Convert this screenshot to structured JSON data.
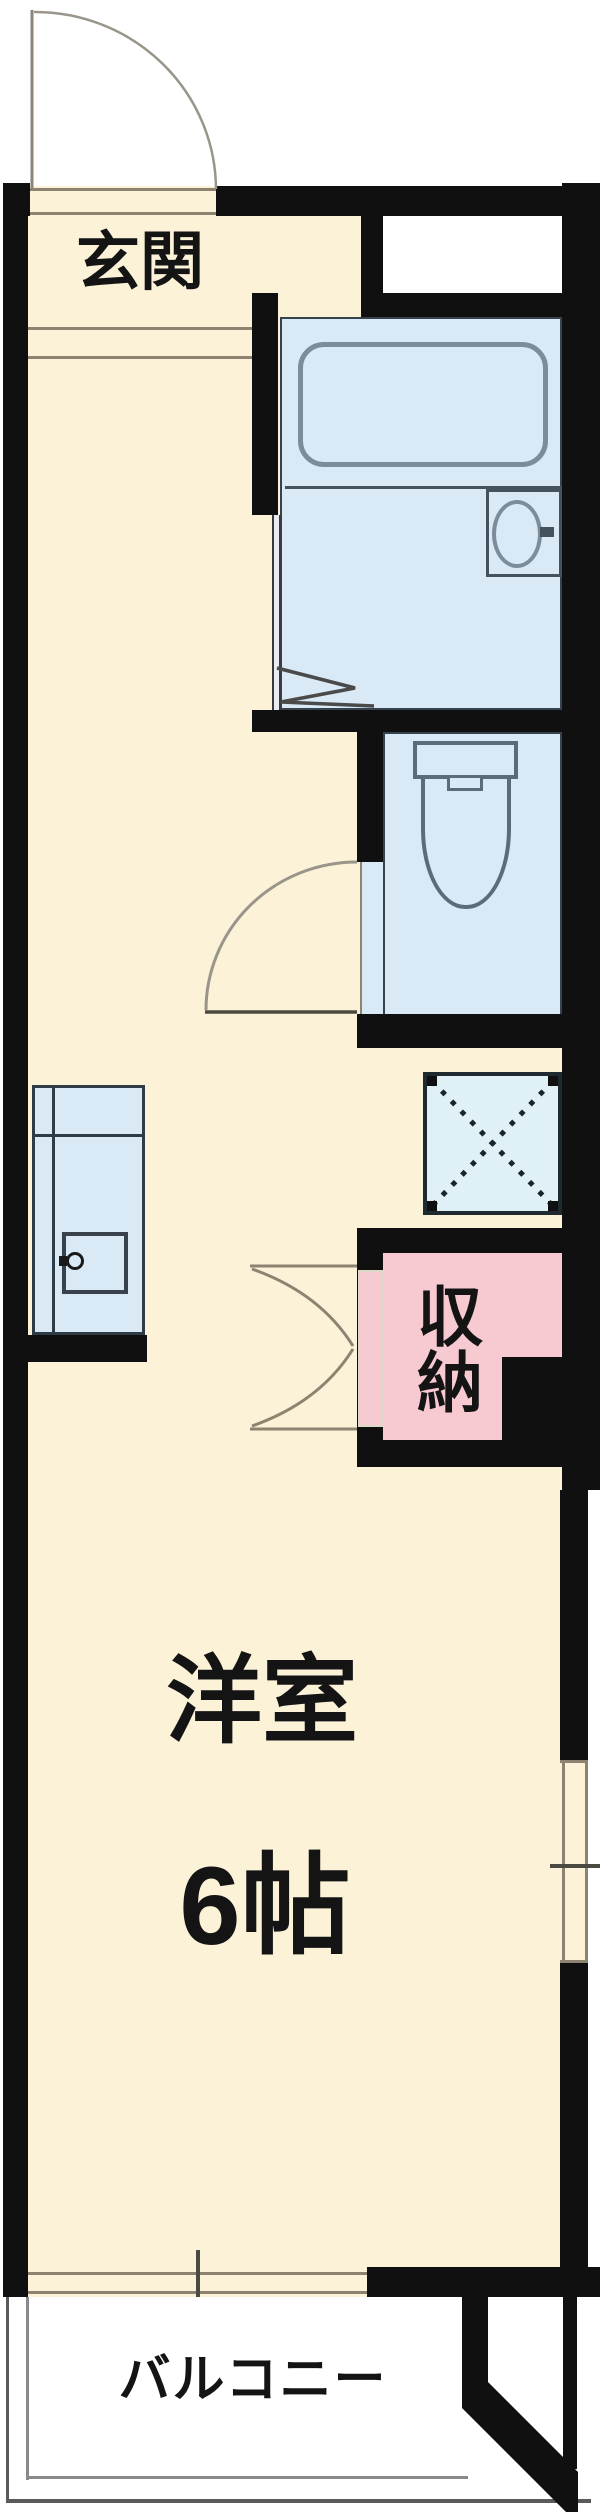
{
  "labels": {
    "entrance": "玄関",
    "storage": "収納",
    "western_room": "洋室",
    "room_size": "6帖",
    "balcony": "バルコニー"
  },
  "rooms": [
    {
      "name": "entrance",
      "label": "玄関"
    },
    {
      "name": "bathroom",
      "label": ""
    },
    {
      "name": "toilet",
      "label": ""
    },
    {
      "name": "kitchen",
      "label": ""
    },
    {
      "name": "washer-pan",
      "label": ""
    },
    {
      "name": "storage",
      "label": "収納"
    },
    {
      "name": "western-room",
      "label": "洋室",
      "size": "6帖"
    },
    {
      "name": "balcony",
      "label": "バルコニー"
    }
  ],
  "colors": {
    "wall": "#101010",
    "floor": "#FBF2D8",
    "wet": "#D9E9F5",
    "pan": "#DFF0F6",
    "pink": "#F7CAD2",
    "lineg": "#8C8471",
    "fix": "#7D8C9B",
    "outside": "#FFFFFF",
    "ink": "#141414"
  }
}
